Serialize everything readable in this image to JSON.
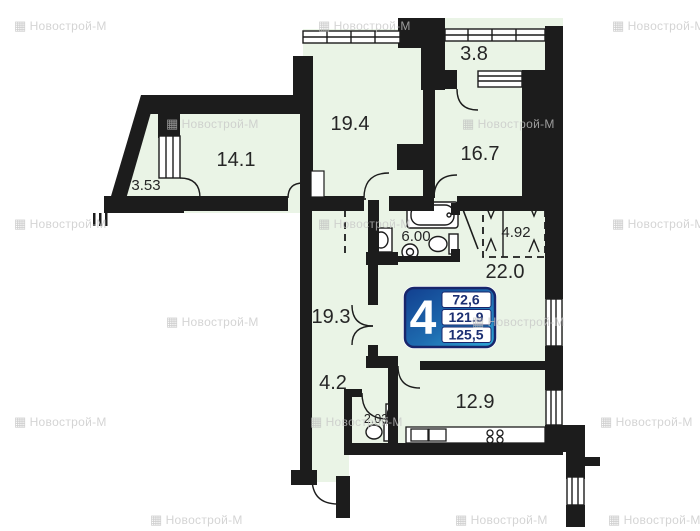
{
  "plan": {
    "watermark": {
      "icon_glyph": "▦",
      "text": "Новострой-М"
    },
    "rooms": {
      "balcony_top": {
        "area": "3.8"
      },
      "living_top": {
        "area": "19.4"
      },
      "bedroom_right": {
        "area": "16.7"
      },
      "bedroom_left": {
        "area": "14.1"
      },
      "balcony_left": {
        "area": "3.53"
      },
      "bathroom": {
        "area": "6.00"
      },
      "wardrobe": {
        "area": "4.92"
      },
      "hallway": {
        "area": "22.0"
      },
      "living_mid": {
        "area": "19.3"
      },
      "corridor": {
        "area": "4.2"
      },
      "wc": {
        "area": "2.03"
      },
      "kitchen": {
        "area": "12.9"
      }
    },
    "badge": {
      "rooms_count": "4",
      "living_area": "72,6",
      "apartment_area": "121.9",
      "total_area": "125,5"
    },
    "colors": {
      "floor": "#eaf4e6",
      "wall": "#1c1c1c",
      "badge_border": "#18266b",
      "badge_gradient_start": "#123f8f",
      "badge_gradient_mid": "#1e6cb0",
      "badge_gradient_end": "#2fa9d8",
      "badge_value_text": "#1c2f72"
    }
  }
}
